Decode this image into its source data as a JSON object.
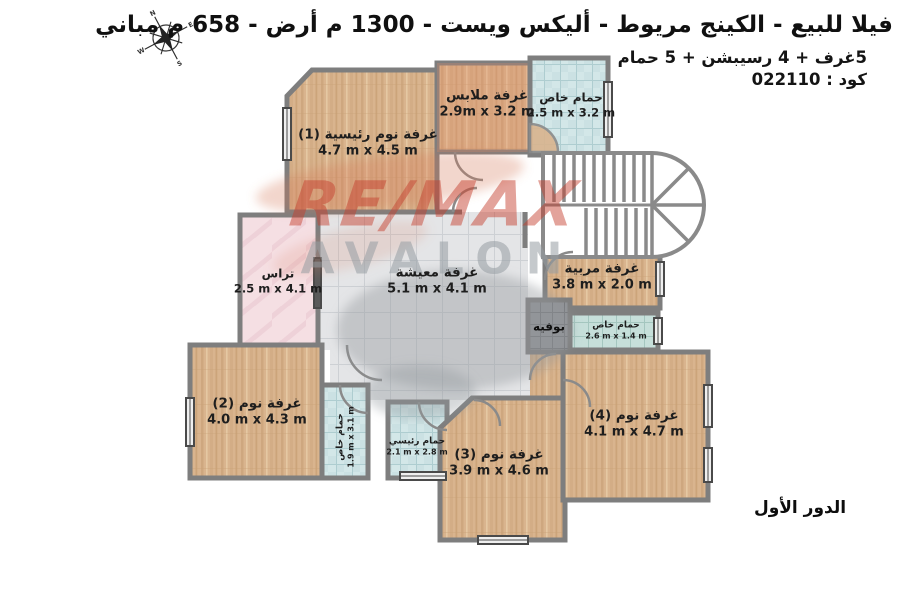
{
  "header": {
    "title": "فيلا للبيع - الكينج مريوط - أليكس ويست - 1300 م أرض - 658 م مباني",
    "subtitle": "5غرف + 4 رسيبشن + 5 حمام",
    "code": "كود : 022110"
  },
  "compass": {
    "n": "N",
    "e": "E",
    "s": "S",
    "w": "W"
  },
  "watermark": {
    "line1": "RE/MAX",
    "line2": "AVALON"
  },
  "floor_label": "الدور الأول",
  "rooms": {
    "master_bedroom": {
      "name": "غرفة نوم رئيسية (1)",
      "dims": "4.7 m x 4.5 m"
    },
    "dressing": {
      "name": "غرفة ملابس",
      "dims": "2.9m x 3.2 m"
    },
    "bath_suite": {
      "name": "حمام خاص",
      "dims": "2.5 m x 3.2 m"
    },
    "terrace": {
      "name": "تراس",
      "dims": "2.5 m x 4.1 m"
    },
    "living": {
      "name": "غرفة معيشة",
      "dims": "5.1 m x 4.1 m"
    },
    "nanny": {
      "name": "غرفة مربية",
      "dims": "3.8 m x 2.0 m"
    },
    "buffet": {
      "name": "بوفيه"
    },
    "bath_service": {
      "name": "حمام خاص",
      "dims": "2.6 m x 1.4 m"
    },
    "bedroom2": {
      "name": "غرفة نوم (2)",
      "dims": "4.0 m x 4.3 m"
    },
    "bath_bedroom2": {
      "name": "حمام خاص",
      "dims": "1.9 m x 3.1 m"
    },
    "master_bath": {
      "name": "حمام رئيسي",
      "dims": "2.1 m x 2.8 m"
    },
    "bedroom3": {
      "name": "غرفة نوم (3)",
      "dims": "3.9 m x 4.6 m"
    },
    "bedroom4": {
      "name": "غرفة نوم (4)",
      "dims": "4.1 m x 4.7 m"
    }
  },
  "colors": {
    "wall": "#7e7e7e",
    "wood_floor": "#d9b48e",
    "dressing_overlay": "#e08a66",
    "bath_tile": "#d3e7e8",
    "service_tile": "#c6dfda",
    "living_tile": "#e4e5e7",
    "terrace": "#f5dfe3",
    "buffet": "#909296",
    "watermark_red": "#c53e2d",
    "watermark_gray": "#969ca2"
  }
}
